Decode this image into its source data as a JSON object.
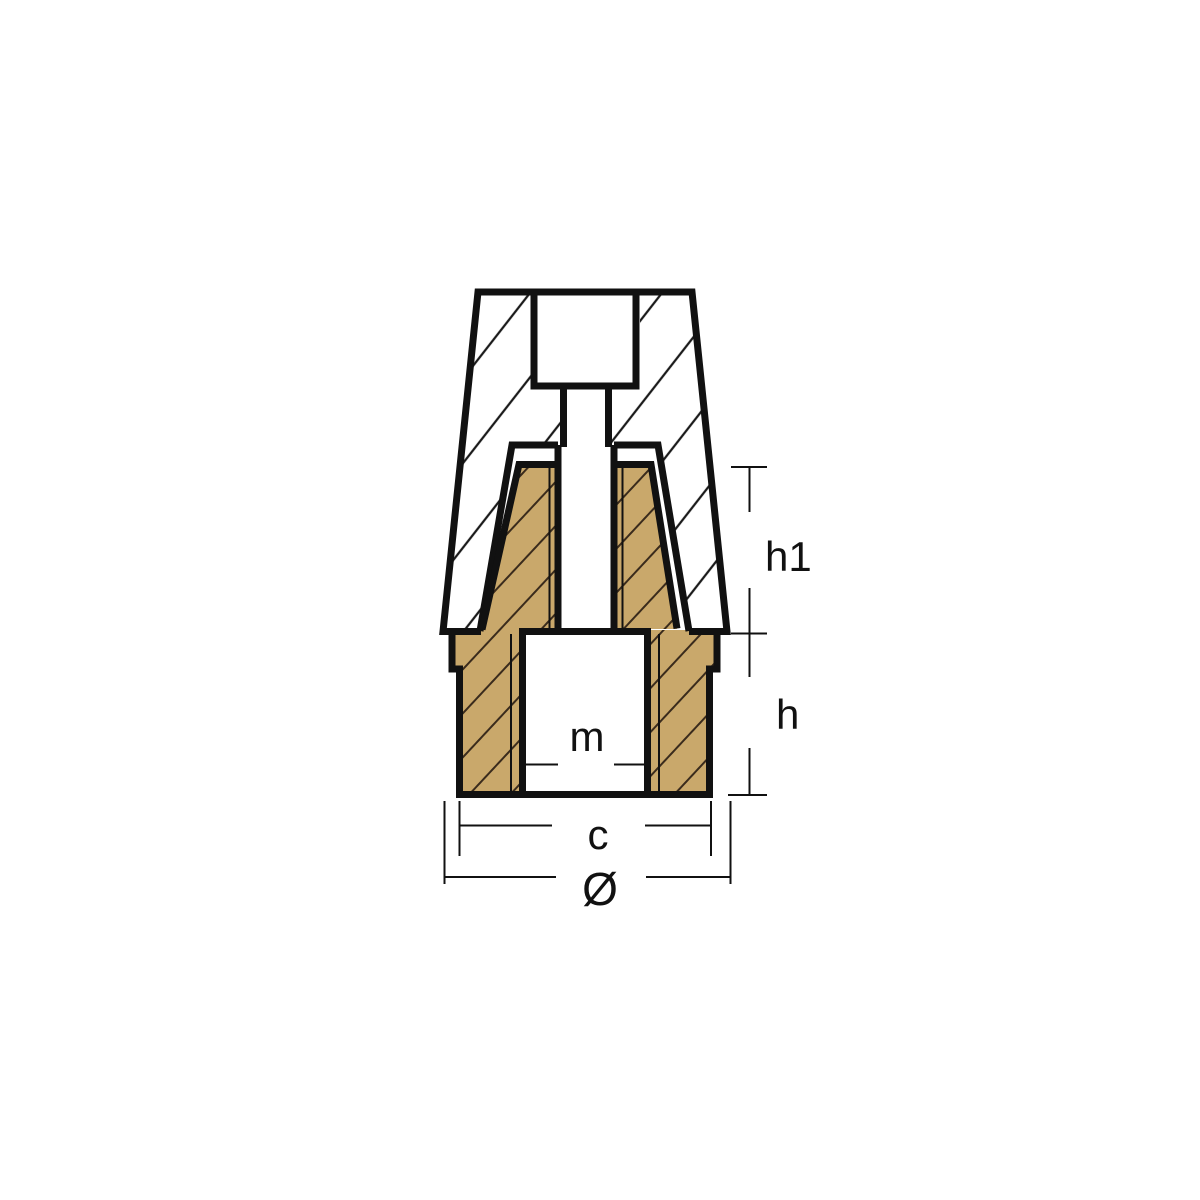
{
  "drawing": {
    "dimension_labels": {
      "h1": "h1",
      "h": "h",
      "c": "c",
      "diameter": "Ø",
      "thread": "m"
    },
    "colors": {
      "background": "#FFFFFF",
      "outline": "#111111",
      "zinc_hatch": "#1A1A1A",
      "brass_fill": "#C9A86B",
      "brass_hatch": "#3A2B1C",
      "dimension_line": "#111111"
    }
  }
}
